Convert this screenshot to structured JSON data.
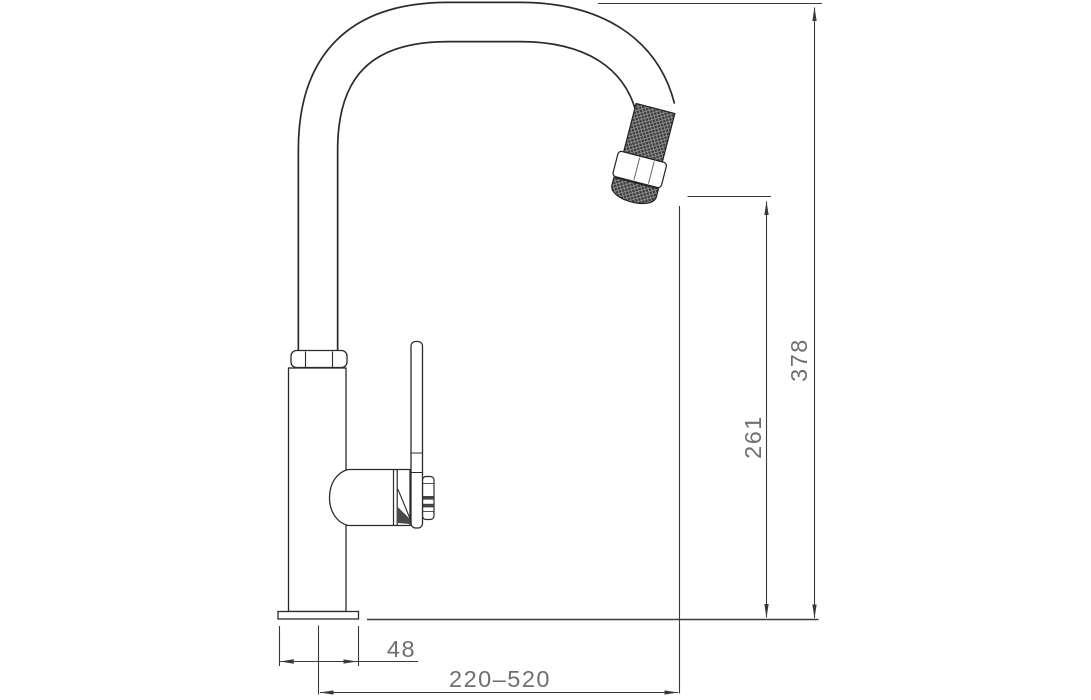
{
  "drawing": {
    "type": "technical dimension drawing",
    "subject": "single-lever kitchen mixer tap with pull-out spray head, side elevation",
    "dimension_labels": {
      "overall_height": "378",
      "spout_outlet_height": "261",
      "base_width": "48",
      "spout_reach_range": "220–520"
    },
    "colors": {
      "background": "#ffffff",
      "object_outline": "#2b2b2b",
      "dimension_lines": "#3a3a3a",
      "dimension_text": "#6f6f6f",
      "knurl_fill": "#3b3b3b"
    }
  }
}
